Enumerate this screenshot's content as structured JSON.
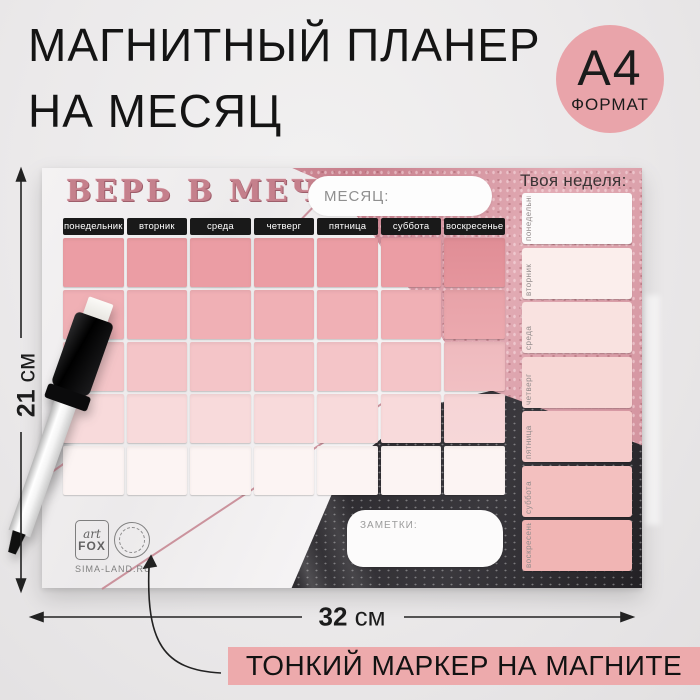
{
  "colors": {
    "accent_pink": "#e9a4aa",
    "banner_pink": "#edaaac",
    "foil_rose": "#d495a0",
    "dark_marble": "#2e2c30",
    "header_bar": "#191919"
  },
  "headline": {
    "line1": "МАГНИТНЫЙ ПЛАНЕР",
    "line2": "НА МЕСЯЦ"
  },
  "format_badge": {
    "size": "А4",
    "label": "ФОРМАТ"
  },
  "dimensions": {
    "height": {
      "value": "21",
      "unit": "см"
    },
    "width": {
      "value": "32",
      "unit": "см"
    }
  },
  "footer_banner": {
    "text": "ТОНКИЙ МАРКЕР НА МАГНИТЕ"
  },
  "planner": {
    "motto": "ВЕРЬ В МЕЧТУ",
    "month_label": "МЕСЯЦ:",
    "week_panel_title": "Твоя неделя:",
    "notes_label": "ЗАМЕТКИ:",
    "weekdays": [
      "понедельник",
      "вторник",
      "среда",
      "четверг",
      "пятница",
      "суббота",
      "воскресенье"
    ],
    "grid": {
      "rows": 5,
      "columns": 7,
      "row_colors": [
        "#eb9da4",
        "#f0b0b5",
        "#f4c5c8",
        "#f8dadb",
        "#fcf4f3"
      ]
    },
    "week_panel_colors": [
      "#fcfafa",
      "#fbeeec",
      "#f9e2e0",
      "#f7d7d5",
      "#f5cbca",
      "#f3c0bf",
      "#f1b5b4"
    ],
    "brand": {
      "logo_top": "art",
      "logo_bottom": "FOX",
      "site": "SIMA-LAND.RU"
    }
  }
}
